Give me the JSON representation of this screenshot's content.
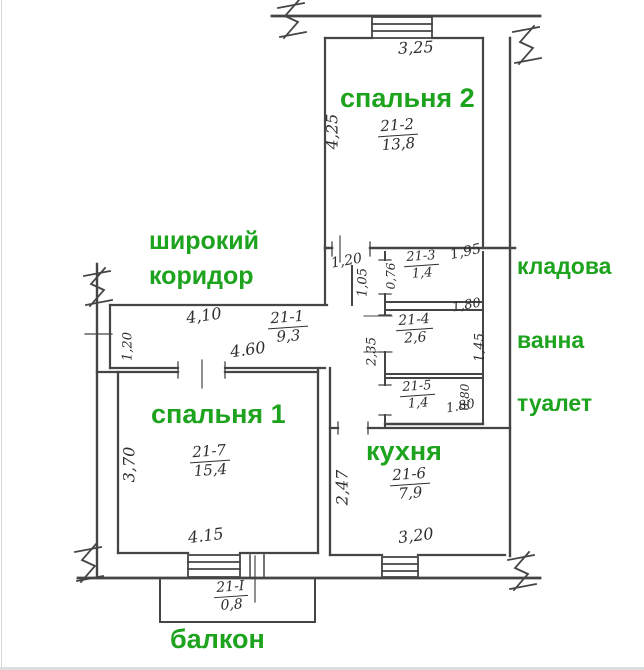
{
  "colors": {
    "room_label_green": "#1da31d",
    "wall_line": "#454545"
  },
  "plan_labels": {
    "bedroom2": {
      "name": "спальня 2",
      "code": "21-2",
      "area": "13,8",
      "dim_width": "3,25",
      "dim_depth": "4,25"
    },
    "corridor": {
      "name_line1": "широкий",
      "name_line2": "коридор",
      "code": "21-1",
      "area": "9,3",
      "dim_top": "4,10",
      "dim_bottom": "4.60",
      "dim_entry": "1,20"
    },
    "pantry": {
      "name": "кладова",
      "code": "21-3",
      "area": "1,4",
      "dim_width": "1,95",
      "dim_door": "1,20",
      "dim_lobby_depth": "1,05",
      "dim_lobby_width": "0,76"
    },
    "bath": {
      "name": "ванна",
      "code": "21-4",
      "area": "2,6",
      "dim_width": "1,80",
      "dim_depth": "1,45",
      "dim_hall": "2,35"
    },
    "toilet": {
      "name": "туалет",
      "code": "21-5",
      "area": "1,4",
      "dim_depth": "0,80",
      "dim_width": "1.80"
    },
    "bedroom1": {
      "name": "спальня 1",
      "code": "21-7",
      "area": "15,4",
      "dim_depth": "3,70",
      "dim_width": "4.15"
    },
    "kitchen": {
      "name": "кухня",
      "code": "21-6",
      "area": "7,9",
      "dim_depth": "2,47",
      "dim_width": "3,20"
    },
    "balcony": {
      "name": "балкон",
      "code": "21-I",
      "area": "0,8"
    }
  }
}
